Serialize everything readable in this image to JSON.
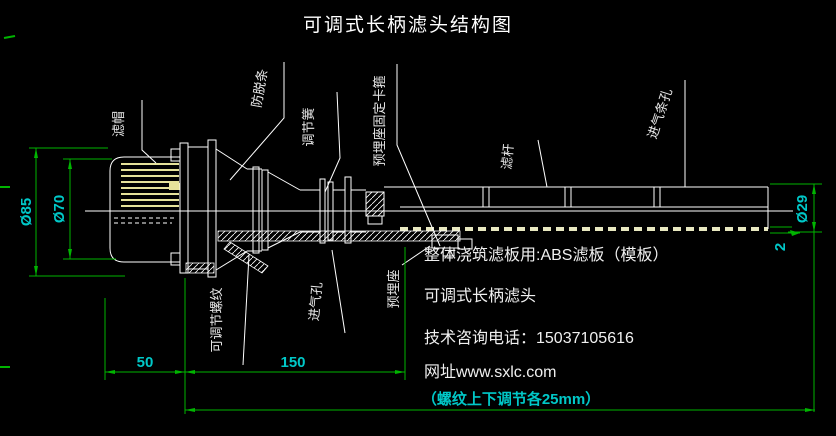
{
  "title": "可调式长柄滤头结构图",
  "colors": {
    "background": "#000000",
    "drawing_line": "#ffffff",
    "highlight_strip": "#e6e29a",
    "dimension_line": "#00b400",
    "dimension_text": "#00c8c8"
  },
  "part_labels": {
    "filter_cap": "滤帽",
    "anti_slip_strip": "防脱条",
    "adjust_spring": "调节簧",
    "embed_seat_clamp": "预埋座固定卡箍",
    "filter_rod": "滤杆",
    "air_inlet_slot": "进气条孔",
    "adjustable_thread": "可调节螺纹",
    "air_inlet_hole": "进气孔",
    "embed_seat": "预埋座"
  },
  "dimensions": {
    "cap_outer_diameter": "Ø85",
    "cap_inner_diameter": "Ø70",
    "rod_diameter": "Ø29",
    "slot_width": "2",
    "length_50": "50",
    "length_150": "150",
    "thread_note": "（螺纹上下调节各25mm）"
  },
  "info": {
    "plate_note": "整体浇筑滤板用:ABS滤板（模板）",
    "product_name": "可调式长柄滤头",
    "phone_line": "技术咨询电话：15037105616",
    "website_line": "网址www.sxlc.com"
  }
}
